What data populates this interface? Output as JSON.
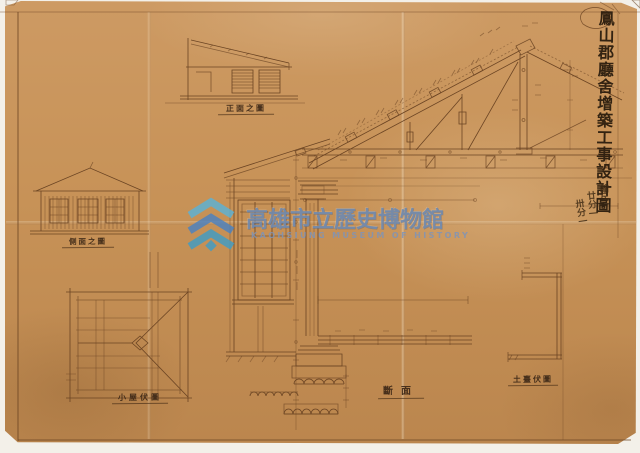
{
  "sheet": {
    "title_vertical": "鳳山郡廳舍增築工事設計圖",
    "scale_label": "縮尺",
    "scale_value_1": "廿分一",
    "scale_value_2": "卅分一"
  },
  "labels": {
    "front_elevation": "正面之圖",
    "side_elevation": "側面之圖",
    "roof_framing_plan": "小屋伏圖",
    "section": "斷面",
    "sill_plan": "土臺伏圖"
  },
  "watermark": {
    "museum_name_zh": "高雄市立歷史博物館",
    "museum_name_en": "KAOHSIUNG MUSEUM OF HISTORY"
  },
  "colors": {
    "paper": "#c6935a",
    "ink": "#6b4423",
    "ink_dark": "#3a2614",
    "accent_purple": "#5a4e8c",
    "watermark_text": "#7490b5",
    "watermark_logo_cyan": "#4fa8cd",
    "watermark_logo_blue": "#4a7fc0",
    "scan_background": "#f3f0e9"
  }
}
